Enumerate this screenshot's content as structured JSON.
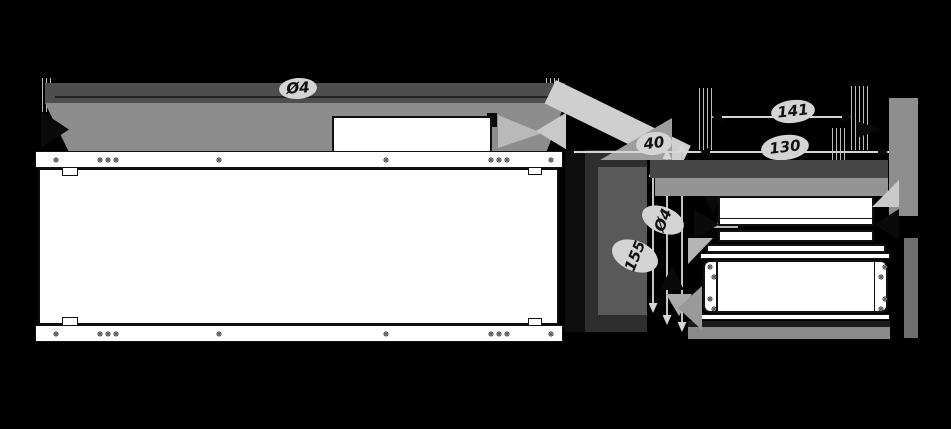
{
  "colors": {
    "background": "#000000",
    "paper": "#ffffff",
    "line": "#111111",
    "gray_dark": "#4e4e4e",
    "gray_mid": "#8d8d8d",
    "gray_light": "#c9c9c9",
    "label_bg": "#d4d4d4",
    "label_text": "#111111"
  },
  "dimensions": {
    "overall_length": "Ø4",
    "gap": "40",
    "side_upper": "141",
    "side_lower": "130",
    "rotated_upper": "Ø4",
    "rotated_lower": "155"
  },
  "front_view": {
    "flange_hole_offsets_x": [
      20,
      64,
      72,
      80,
      183,
      350,
      455,
      463,
      471,
      515
    ]
  },
  "bottom_view": {
    "plate_holes": [
      {
        "x": 5,
        "y": 5
      },
      {
        "x": 9,
        "y": 15
      },
      {
        "x": 5,
        "y": 37
      },
      {
        "x": 9,
        "y": 47
      },
      {
        "x": 180,
        "y": 5
      },
      {
        "x": 176,
        "y": 15
      },
      {
        "x": 180,
        "y": 37
      },
      {
        "x": 176,
        "y": 47
      }
    ]
  }
}
